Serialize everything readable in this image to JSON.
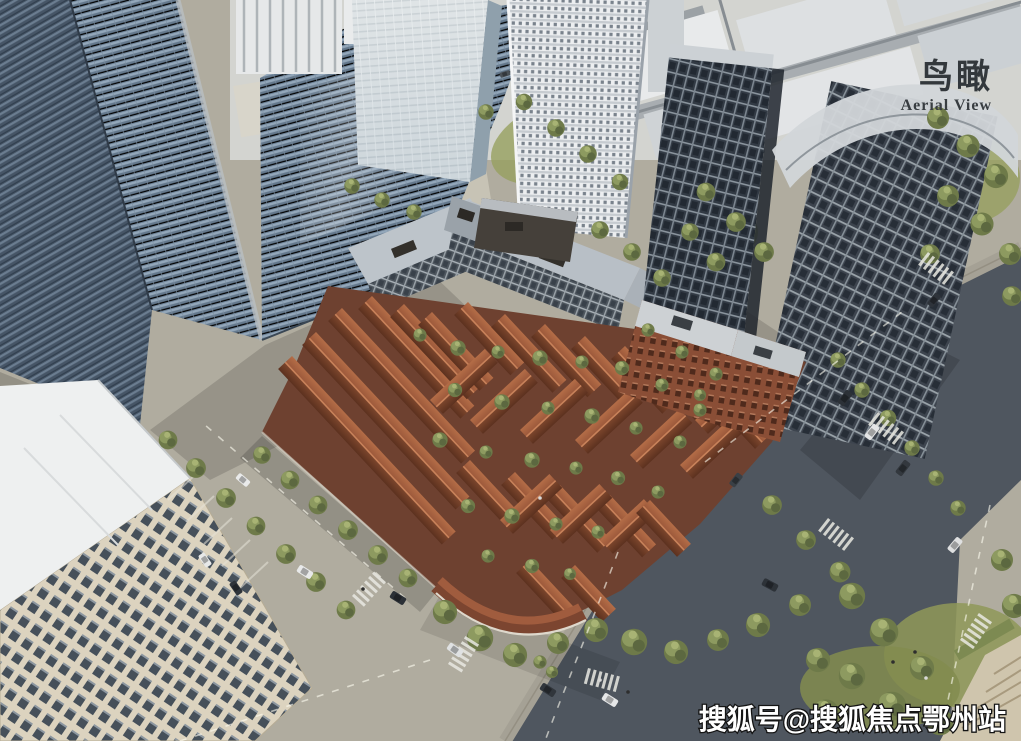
{
  "overlay": {
    "title_cn": "鸟瞰",
    "title_en": "Aerial View"
  },
  "watermark": "搜狐号@搜狐焦点鄂州站",
  "palette": {
    "pavement": "#b0ac9f",
    "asphalt_road": "#4f565f",
    "tree_green": "#6e7a49",
    "tree_green_light": "#8d9a60",
    "tile_roof_red": "#9a573a",
    "tile_roof_shadow": "#5c311f",
    "brick_facade": "#8a4e36",
    "glass_tower_blue": "#64788c",
    "glass_tower_blue_dark": "#465566",
    "dark_tower_glass": "#323a44",
    "white_tower": "#eceef0",
    "beige_building": "#dcd3bf",
    "city_light_gray": "#d9dcde",
    "label_text": "#33383c",
    "watermark_text": "#ffffff"
  },
  "scene": {
    "type": "aerial-architectural-rendering",
    "elements": [
      "blue-glass-office-towers",
      "pale-glass-tower",
      "white-balcony-tower",
      "dark-glass-high-rise-towers",
      "historic-red-brick-lane-block",
      "gabled-red-tile-roofs",
      "courtyard-trees",
      "red-brick-midrise-buildings",
      "gray-glass-midrise-l-building",
      "beige-office-building",
      "low-rise-industrial-rows",
      "city-streets",
      "intersections-with-crosswalks",
      "street-trees",
      "cars",
      "pedestrians"
    ]
  }
}
